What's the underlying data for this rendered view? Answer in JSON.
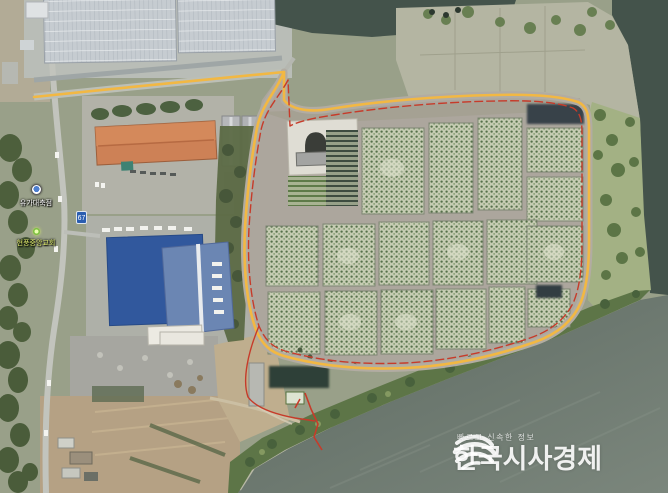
{
  "watermark": {
    "tagline": "빠르고 신속한 정보",
    "title": "한국시사경제",
    "icon": "wave-globe-icon",
    "color": "#ffffff"
  },
  "map_labels": {
    "poi_1": "유가대축점",
    "poi_2": "현풍중앙교회",
    "road_badge": "67"
  },
  "colors": {
    "route_yellow": "#f2b843",
    "boundary_red": "#c63b2a",
    "water_dark": "#44534b",
    "water_light": "#7b867c",
    "nursery_green": "#c6ccb3",
    "orange_roof": "#cd8156",
    "blue_roof": "#31589d",
    "censored_block": "#38424a"
  }
}
